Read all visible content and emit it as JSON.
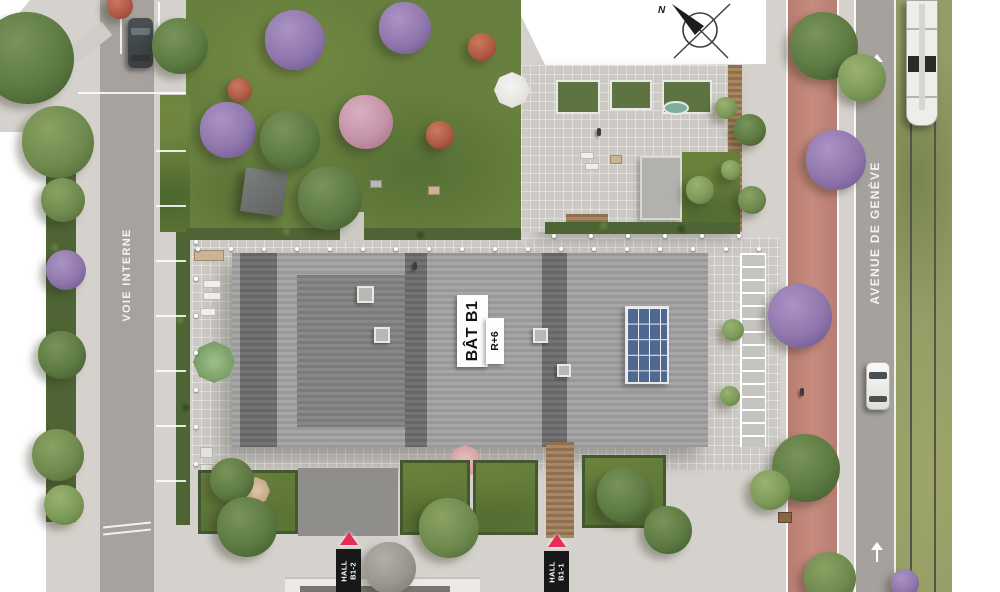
{
  "labels": {
    "building": {
      "name": "BÂT B1",
      "floors": "R+6"
    },
    "street_left": "VOIE INTERNE",
    "street_right": "AVENUE DE GENÈVE",
    "hall_b1_2": {
      "line1": "HALL",
      "line2": "B1-2"
    },
    "hall_b1_1": {
      "line1": "HALL",
      "line2": "B1-1"
    },
    "compass": "N"
  },
  "colors": {
    "accent_red": "#e62e56",
    "roof_light": "#9e9e9e",
    "roof_dark": "#6e6e6e",
    "solar_blue": "#50678f",
    "bike_path": "#bf8378",
    "grass": "#68803f",
    "road": "#a7a29d",
    "pavement": "#d5d2cd",
    "marker_bg": "#181818",
    "marker_text": "#ffffff"
  },
  "landscape": {
    "tree_types": {
      "green1": {
        "base": "#6f8a4e",
        "light": "#8aa364",
        "dark": "#4f6835"
      },
      "green2": {
        "base": "#5d7a42",
        "light": "#78945a",
        "dark": "#3f5a2c"
      },
      "green3": {
        "base": "#7d9a58",
        "light": "#9ab273",
        "dark": "#5c7840"
      },
      "purple": {
        "base": "#8f77ad",
        "light": "#ab93c6",
        "dark": "#6b5589"
      },
      "pink": {
        "base": "#c493a8",
        "light": "#d9afc0",
        "dark": "#a3718a"
      },
      "red": {
        "base": "#b05a43",
        "light": "#c97a5f",
        "dark": "#8a3f2e"
      },
      "gray": {
        "base": "#9a958e",
        "light": "#b3aea6",
        "dark": "#7b766f"
      }
    },
    "trees": [
      {
        "x": 28,
        "y": 58,
        "r": 46,
        "t": "green2"
      },
      {
        "x": 58,
        "y": 142,
        "r": 36,
        "t": "green1"
      },
      {
        "x": 120,
        "y": 6,
        "r": 13,
        "t": "red"
      },
      {
        "x": 180,
        "y": 46,
        "r": 28,
        "t": "green2"
      },
      {
        "x": 240,
        "y": 90,
        "r": 12,
        "t": "red"
      },
      {
        "x": 228,
        "y": 130,
        "r": 28,
        "t": "purple"
      },
      {
        "x": 295,
        "y": 40,
        "r": 30,
        "t": "purple"
      },
      {
        "x": 405,
        "y": 28,
        "r": 26,
        "t": "purple"
      },
      {
        "x": 366,
        "y": 122,
        "r": 27,
        "t": "pink"
      },
      {
        "x": 290,
        "y": 140,
        "r": 30,
        "t": "green2"
      },
      {
        "x": 482,
        "y": 47,
        "r": 14,
        "t": "red"
      },
      {
        "x": 440,
        "y": 135,
        "r": 14,
        "t": "red"
      },
      {
        "x": 330,
        "y": 198,
        "r": 32,
        "t": "green2"
      },
      {
        "x": 63,
        "y": 200,
        "r": 22,
        "t": "green1"
      },
      {
        "x": 66,
        "y": 270,
        "r": 20,
        "t": "purple"
      },
      {
        "x": 62,
        "y": 355,
        "r": 24,
        "t": "green2"
      },
      {
        "x": 58,
        "y": 455,
        "r": 26,
        "t": "green1"
      },
      {
        "x": 64,
        "y": 505,
        "r": 20,
        "t": "green3"
      },
      {
        "x": 726,
        "y": 108,
        "r": 11,
        "t": "green3"
      },
      {
        "x": 731,
        "y": 170,
        "r": 10,
        "t": "green3"
      },
      {
        "x": 733,
        "y": 330,
        "r": 11,
        "t": "green3"
      },
      {
        "x": 730,
        "y": 396,
        "r": 10,
        "t": "green3"
      },
      {
        "x": 700,
        "y": 190,
        "r": 14,
        "t": "green3"
      },
      {
        "x": 750,
        "y": 130,
        "r": 16,
        "t": "green2"
      },
      {
        "x": 752,
        "y": 200,
        "r": 14,
        "t": "green1"
      },
      {
        "x": 824,
        "y": 46,
        "r": 34,
        "t": "green2"
      },
      {
        "x": 862,
        "y": 78,
        "r": 24,
        "t": "green3"
      },
      {
        "x": 836,
        "y": 160,
        "r": 30,
        "t": "purple"
      },
      {
        "x": 800,
        "y": 316,
        "r": 32,
        "t": "purple"
      },
      {
        "x": 806,
        "y": 468,
        "r": 34,
        "t": "green2"
      },
      {
        "x": 830,
        "y": 578,
        "r": 26,
        "t": "green1"
      },
      {
        "x": 770,
        "y": 490,
        "r": 20,
        "t": "green3"
      },
      {
        "x": 232,
        "y": 480,
        "r": 22,
        "t": "green2"
      },
      {
        "x": 247,
        "y": 527,
        "r": 30,
        "t": "green2"
      },
      {
        "x": 449,
        "y": 528,
        "r": 30,
        "t": "green1"
      },
      {
        "x": 390,
        "y": 568,
        "r": 26,
        "t": "gray"
      },
      {
        "x": 625,
        "y": 495,
        "r": 28,
        "t": "green2"
      },
      {
        "x": 668,
        "y": 530,
        "r": 24,
        "t": "green2"
      },
      {
        "x": 905,
        "y": 583,
        "r": 14,
        "t": "purple"
      }
    ],
    "figures": [
      {
        "x": 800,
        "y": 388
      },
      {
        "x": 348,
        "y": 562
      },
      {
        "x": 413,
        "y": 262
      },
      {
        "x": 597,
        "y": 128
      }
    ]
  }
}
